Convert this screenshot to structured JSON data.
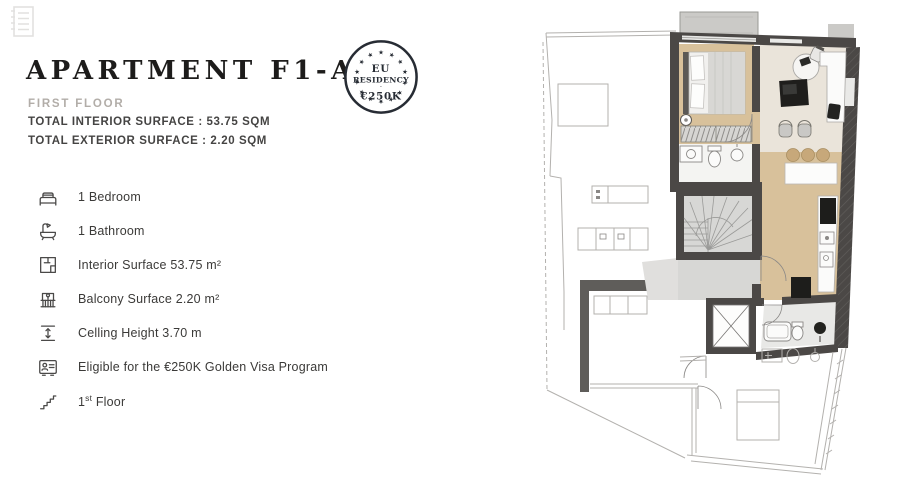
{
  "page": {
    "background": "#ffffff"
  },
  "colors": {
    "title_text": "#1d1c1b",
    "muted_text": "#b2ada8",
    "surface_text": "#454443",
    "body_text": "#3b3a38",
    "icon_stroke": "#4a4948",
    "badge_navy": "#272c34",
    "wall": "#4b4846",
    "floor_tan": "#d8c19b",
    "floor_light": "#eae4da",
    "stair_gray": "#d7d7d5",
    "balcony_gray": "#cbcac7",
    "outline_gray": "#b3b1ae",
    "fixture_dark": "#1d1d1b",
    "stool_tan": "#c7a87a"
  },
  "header": {
    "title": "APARTMENT F1-A2",
    "floor_label": "FIRST FLOOR",
    "interior_line": "TOTAL INTERIOR SURFACE : 53.75 SQM",
    "exterior_line": "TOTAL EXTERIOR SURFACE : 2.20 SQM"
  },
  "badge": {
    "line1": "EU",
    "line2": "RESIDENCY",
    "separator": "·",
    "line3": "€250K"
  },
  "features": [
    {
      "icon": "bed-icon",
      "label": "1 Bedroom"
    },
    {
      "icon": "bathtub-icon",
      "label": "1 Bathroom"
    },
    {
      "icon": "floorplan-icon",
      "label": "Interior Surface 53.75 m²"
    },
    {
      "icon": "balcony-icon",
      "label": "Balcony Surface 2.20 m²"
    },
    {
      "icon": "height-icon",
      "label": "Celling Height 3.70 m"
    },
    {
      "icon": "idcard-icon",
      "label": "Eligible for the €250K Golden Visa Program"
    },
    {
      "icon": "stairs-icon",
      "label_prefix": "1",
      "label_sup": "st",
      "label_rest": " Floor"
    }
  ]
}
